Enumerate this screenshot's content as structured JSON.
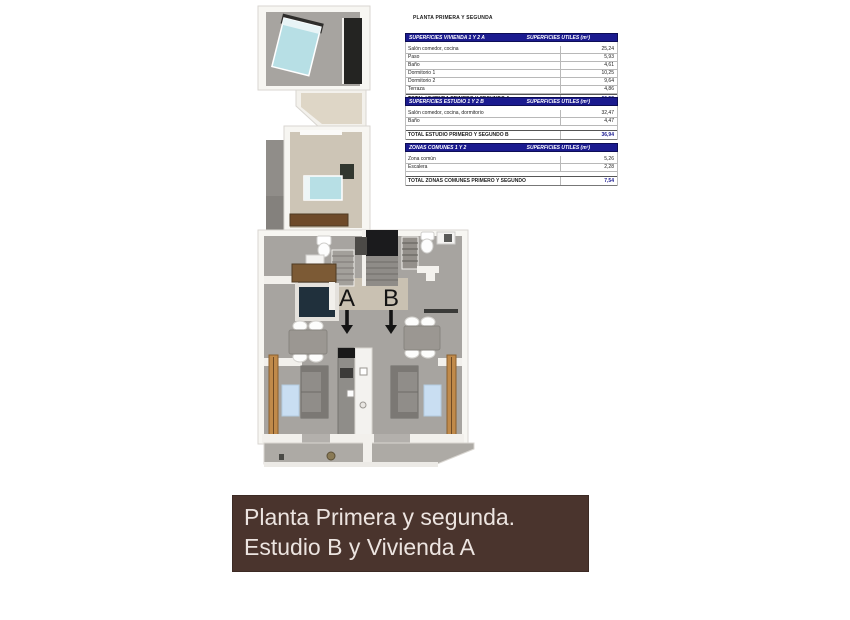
{
  "document": {
    "title": "PLANTA PRIMERA Y SEGUNDA"
  },
  "tables": {
    "vivienda": {
      "header_left": "SUPERFICIES VIVIENDA 1 Y 2 A",
      "header_right": "SUPERFICIES UTILES  (m²)",
      "rows": [
        {
          "label": "Salón comedor, cocina",
          "value": "25,24"
        },
        {
          "label": "Paso",
          "value": "5,93"
        },
        {
          "label": "Baño",
          "value": "4,61"
        },
        {
          "label": "Dormitorio 1",
          "value": "10,25"
        },
        {
          "label": "Dormitorio 2",
          "value": "9,64"
        },
        {
          "label": "Terraza",
          "value": "4,86"
        }
      ],
      "total_label": "TOTAL VIVIENDA PRIMERO Y SEGUNDO A",
      "total_value": "60,53"
    },
    "estudio": {
      "header_left": "SUPERFICIES ESTUDIO 1 Y 2 B",
      "header_right": "SUPERFICIES UTILES  (m²)",
      "rows": [
        {
          "label": "Salón comedor, cocina, dormitorio",
          "value": "32,47"
        },
        {
          "label": "Baño",
          "value": "4,47"
        }
      ],
      "total_label": "TOTAL ESTUDIO PRIMERO Y SEGUNDO B",
      "total_value": "36,94"
    },
    "zonas": {
      "header_left": "ZONAS COMUNES 1 Y 2",
      "header_right": "SUPERFICIES UTILES  (m²)",
      "rows": [
        {
          "label": "Zona común",
          "value": "5,26"
        },
        {
          "label": "Escalera",
          "value": "2,28"
        }
      ],
      "total_label": "TOTAL ZONAS COMUNES PRIMERO Y SEGUNDO",
      "total_value": "7,54"
    }
  },
  "plan": {
    "unit_a_label": "A",
    "unit_b_label": "B"
  },
  "banner": {
    "line1": "Planta Primera y segunda.",
    "line2": "Estudio B y Vivienda A"
  },
  "colors": {
    "table_header_bg": "#1b1b8f",
    "total_value_color": "#1b1b8f",
    "banner_bg": "#4a342d",
    "banner_text": "#ece4e0",
    "floor_gray": "#a7a4a0",
    "floor_beige": "#cdc5b6",
    "bed_blue": "#b7dfe5",
    "wood_brown": "#6e4a29"
  }
}
